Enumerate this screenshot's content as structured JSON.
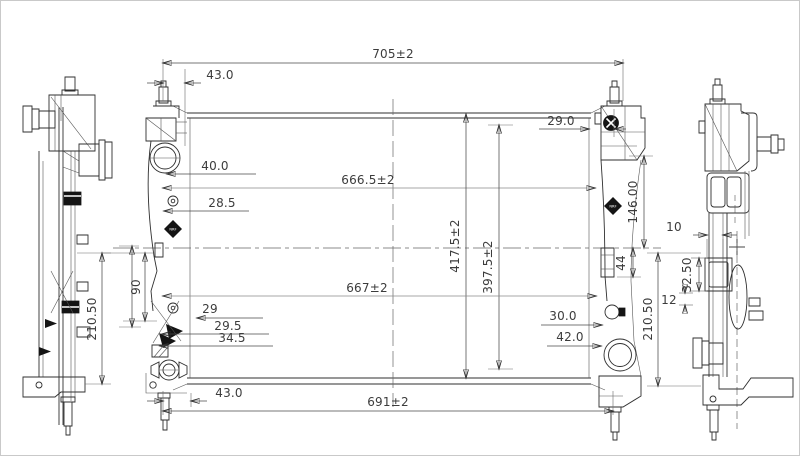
{
  "drawing": {
    "type": "radiator-engineering-drawing",
    "colors": {
      "background": "#ffffff",
      "line": "#2f2f2f",
      "dim_text": "#3c3c3c"
    }
  },
  "logo": {
    "text": "NRF"
  },
  "dimensions": {
    "overall_width": "705±2",
    "top_left_offset": "43.0",
    "top_right_offset": "29.0",
    "filler_offset": "40.0",
    "upper_core_width": "666.5±2",
    "bolt_offset": "28.5",
    "right_bracket_height": "146.00",
    "overall_height": "417.5±2",
    "core_height": "397.5±2",
    "lower_core_width": "667±2",
    "left_bracket_span": "90",
    "lower_left_d1": "29",
    "lower_left_d2": "29.5",
    "lower_left_d3": "34.5",
    "outlet_hole_offset": "30.0",
    "outlet_offset": "42.0",
    "right_tab_height": "44",
    "left_view_height": "210.50",
    "right_view_height": "210.50",
    "bottom_left_offset": "43.0",
    "bottom_width": "691±2",
    "side_band_width": "10",
    "side_block_height": "32.50",
    "side_gap": "12"
  }
}
